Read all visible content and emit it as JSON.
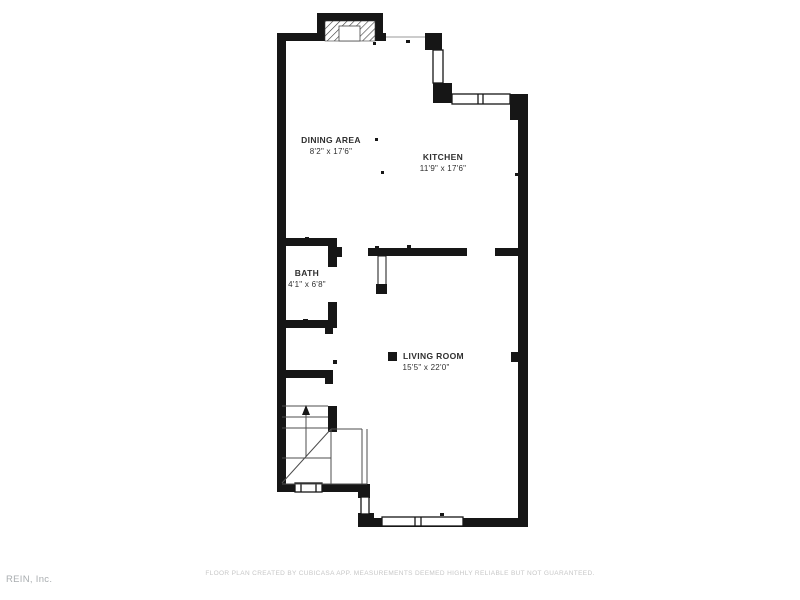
{
  "document": {
    "type": "floor-plan",
    "background": "#ffffff"
  },
  "colors": {
    "wall": "#161616",
    "thin_line": "#4d4d4d",
    "label_text": "#2f2f2f",
    "disclaimer_text": "#c7c7c7",
    "watermark_text": "#a9adb0"
  },
  "rooms": [
    {
      "name": "DINING AREA",
      "dimensions": "8'2\" x 17'6\""
    },
    {
      "name": "KITCHEN",
      "dimensions": "11'9\" x 17'6\""
    },
    {
      "name": "BATH",
      "dimensions": "4'1\" x 6'8\""
    },
    {
      "name": "LIVING ROOM",
      "dimensions": "15'5\" x 22'0\""
    }
  ],
  "features": [
    "fireplace",
    "staircase-up-arrow",
    "open-door",
    "windows",
    "living-room-marker-square"
  ],
  "footer": {
    "disclaimer": "FLOOR PLAN CREATED BY CUBICASA APP. MEASUREMENTS DEEMED HIGHLY RELIABLE BUT NOT GUARANTEED.",
    "watermark": "REIN, Inc."
  }
}
